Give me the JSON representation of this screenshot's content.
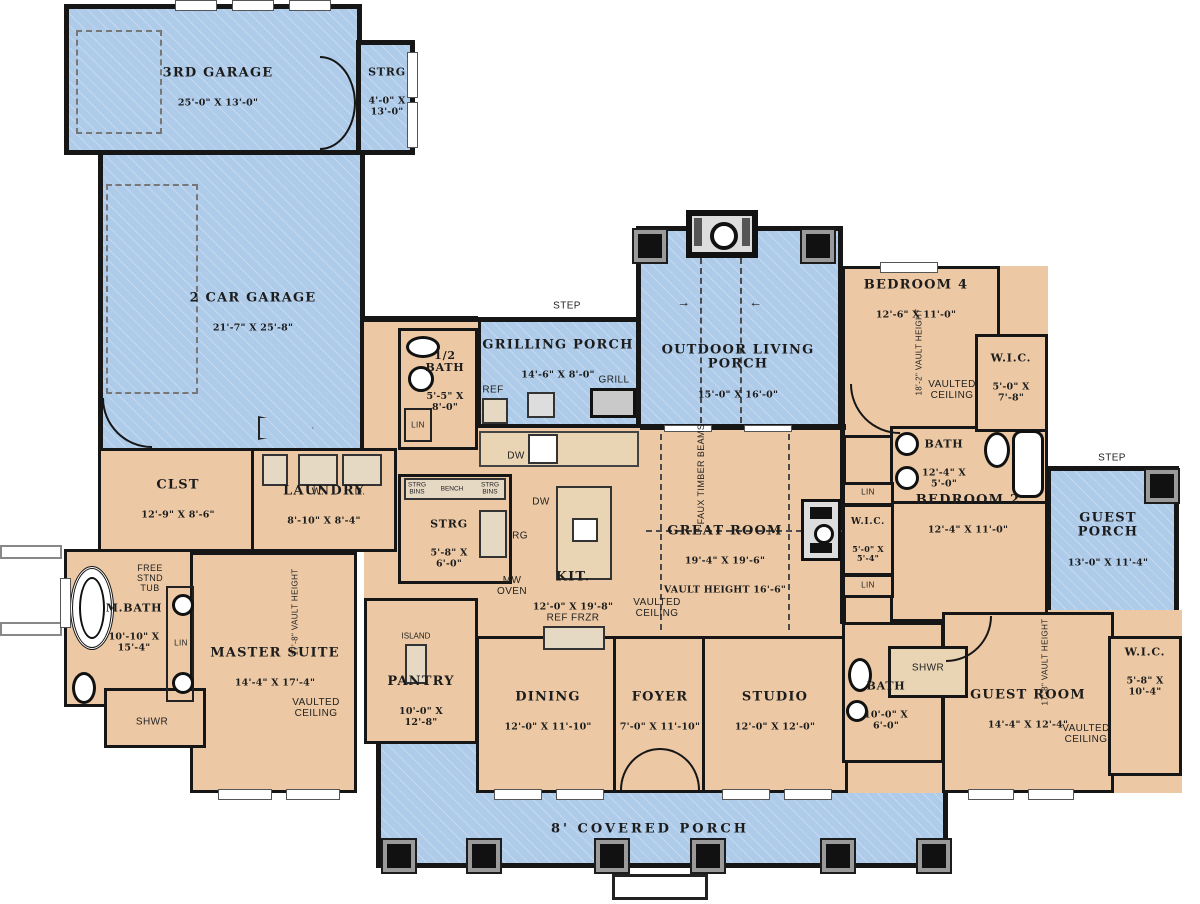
{
  "title": "First floor plan",
  "colors": {
    "porch_blue": "#aecbe9",
    "interior_tan": "#ecc9a4",
    "wall_black": "#161616",
    "background": "#ffffff"
  },
  "rooms": {
    "garage3": {
      "name": "3RD GARAGE",
      "dims": "25'-0\" X 13'-0\""
    },
    "strg_garage": {
      "name": "STRG",
      "dims": "4'-0\" X\n13'-0\""
    },
    "garage2": {
      "name": "2 CAR GARAGE",
      "dims": "21'-7\" X 25'-8\""
    },
    "grilling": {
      "name": "GRILLING PORCH",
      "dims": "14'-6\" X 8'-0\""
    },
    "outdoor": {
      "name": "OUTDOOR LIVING\nPORCH",
      "dims": "15'-0\" X 16'-0\""
    },
    "guest_porch": {
      "name": "GUEST PORCH",
      "dims": "13'-0\" X 11'-4\""
    },
    "halfbath": {
      "name": "1/2\nBATH",
      "dims": "5'-5\" X\n8'-0\""
    },
    "clst": {
      "name": "CLST",
      "dims": "12'-9\" X 8'-6\""
    },
    "laundry": {
      "name": "LAUNDRY",
      "dims": "8'-10\" X 8'-4\""
    },
    "mbath": {
      "name": "M.BATH",
      "dims": "10'-10\" X\n15'-4\""
    },
    "master": {
      "name": "MASTER SUITE",
      "dims": "14'-4\" X 17'-4\""
    },
    "strg_mud": {
      "name": "STRG",
      "dims": "5'-8\" X\n6'-0\""
    },
    "pantry": {
      "name": "PANTRY",
      "dims": "10'-0\" X\n12'-8\""
    },
    "kitchen": {
      "name": "KIT.",
      "dims": "12'-0\" X 19'-8\""
    },
    "great": {
      "name": "GREAT ROOM",
      "dims": "19'-4\" X 19'-6\"",
      "extra": "VAULT HEIGHT 16'-6\""
    },
    "wic_hall": {
      "name": "W.I.C.",
      "dims": "5'-0\" X\n5'-4\""
    },
    "dining": {
      "name": "DINING",
      "dims": "12'-0\" X 11'-10\""
    },
    "foyer": {
      "name": "FOYER",
      "dims": "7'-0\" X 11'-10\""
    },
    "studio": {
      "name": "STUDIO",
      "dims": "12'-0\" X 12'-0\""
    },
    "bedroom4": {
      "name": "BEDROOM 4",
      "dims": "12'-6\" X 11'-0\""
    },
    "wic4": {
      "name": "W.I.C.",
      "dims": "5'-0\" X\n7'-8\""
    },
    "bath4": {
      "name": "BATH",
      "dims": "12'-4\" X\n5'-0\""
    },
    "bedroom2": {
      "name": "BEDROOM 2",
      "dims": "12'-4\" X 11'-0\""
    },
    "guest_bath": {
      "name": "BATH",
      "dims": "10'-0\" X\n6'-0\""
    },
    "guest_room": {
      "name": "GUEST ROOM",
      "dims": "14'-4\" X 12'-4\""
    },
    "wic_guest": {
      "name": "W.I.C.",
      "dims": "5'-8\" X\n10'-4\""
    },
    "covered_porch": {
      "name": "8' COVERED PORCH"
    }
  },
  "annotations": {
    "step": "STEP",
    "ref": "REF",
    "grill": "GRILL",
    "dw": "DW",
    "rg": "RG",
    "mw_oven": "MW\nOVEN",
    "ref_frzr": "REF   FRZR",
    "w": "W.",
    "d": "D.",
    "lin": "LIN",
    "shwr": "SHWR",
    "island": "ISLAND",
    "bench": "BENCH",
    "strg_bins": "STRG\nBINS",
    "free_stnd_tub": "FREE\nSTND\nTUB",
    "faux_timber_beams": "FAUX TIMBER BEAMS",
    "vaulted_ceiling": "VAULTED\nCEILING",
    "vault_17_8": "17'-8\" VAULT HEIGHT",
    "vault_18_2": "18'-2\" VAULT HEIGHT"
  }
}
